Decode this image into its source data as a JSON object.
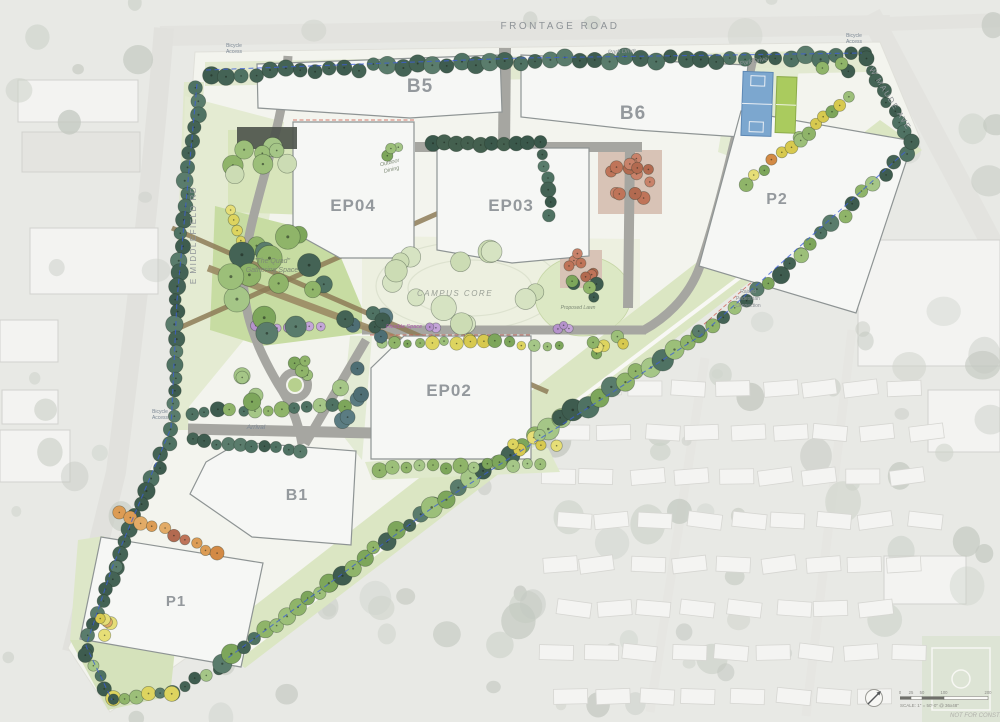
{
  "map": {
    "roads": {
      "frontage": "FRONTAGE ROAD",
      "middlefield": "E MIDDLEFIELD RD",
      "maude": "W MAUDE AVE",
      "park_drive": "Park Drive"
    },
    "buildings": {
      "b5": "B5",
      "b6": "B6",
      "p2": "P2",
      "ep04": "EP04",
      "ep03": "EP03",
      "ep02": "EP02",
      "b1": "B1",
      "p1": "P1"
    },
    "labels": {
      "campus_core": "CAMPUS CORE",
      "quad_line1": "\"The Quad\"",
      "quad_line2": "Gathering Space",
      "outdoor_dining_line1": "Outdoor",
      "outdoor_dining_line2": "Dining",
      "proposed_lawn": "Proposed Lawn",
      "arrival": "Arrival",
      "bicycle_line1": "Bicycle",
      "bicycle_line2": "Access",
      "raised_ped_line1": "Raised",
      "raised_ped_line2": "Pedestrian",
      "raised_ped_line3": "Connection",
      "flexible_space": "Flexible Space"
    },
    "scalebar": {
      "ticks": [
        "0",
        "25",
        "50",
        "100",
        "200"
      ],
      "scale_note": "SCALE: 1\" = 50'-0\" @ 36x48\"",
      "stamp": "NOT FOR CONSTRUCTION"
    },
    "colors": {
      "evergreen": "#4f7263",
      "canopy_green": "#8fb469",
      "lawn": "#c7dca2",
      "accent_yellow": "#ddd45f",
      "accent_orange": "#dc9c55",
      "court_blue": "#7ca7cf",
      "court_green": "#aacb5e",
      "shrub_purple": "#b592cb",
      "path_brown": "#8d7b57",
      "bike_route_blue": "#3c5ed8"
    }
  }
}
